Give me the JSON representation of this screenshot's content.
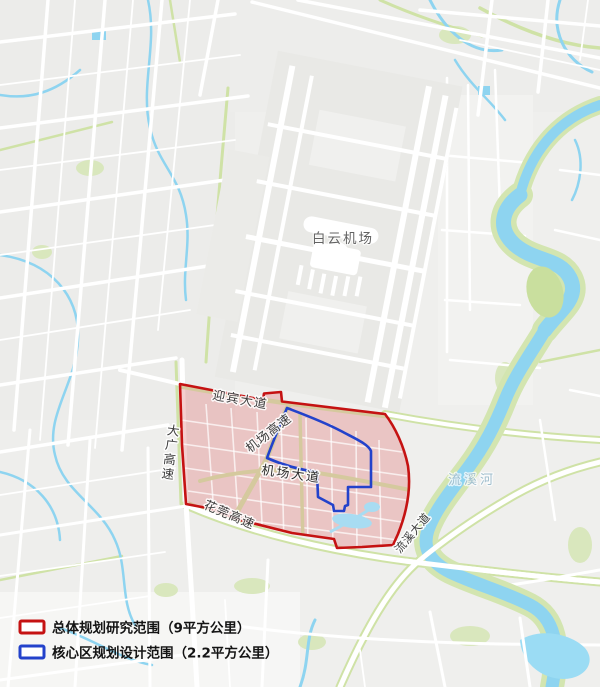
{
  "map": {
    "airport_label": "白云机场",
    "river_label": "流溪河",
    "road_labels": {
      "yingbin_avenue": "迎宾大道",
      "daguang_expressway": "大广高速",
      "airport_expressway": "机场高速",
      "airport_avenue": "机场大道",
      "huaguan_expressway": "花莞高速",
      "liuxi_avenue": "流溪大道"
    },
    "colors": {
      "overall_boundary_red": "#c51212",
      "core_boundary_blue": "#2342cb",
      "overall_fill": "rgba(225,128,128,0.38)",
      "water": "#8ed4f0",
      "green": "#cfe2a6"
    }
  },
  "legend": {
    "items": [
      {
        "label": "总体规划研究范围（9平方公里）",
        "color": "#c51212"
      },
      {
        "label": "核心区规划设计范围（2.2平方公里）",
        "color": "#2342cb"
      }
    ]
  }
}
